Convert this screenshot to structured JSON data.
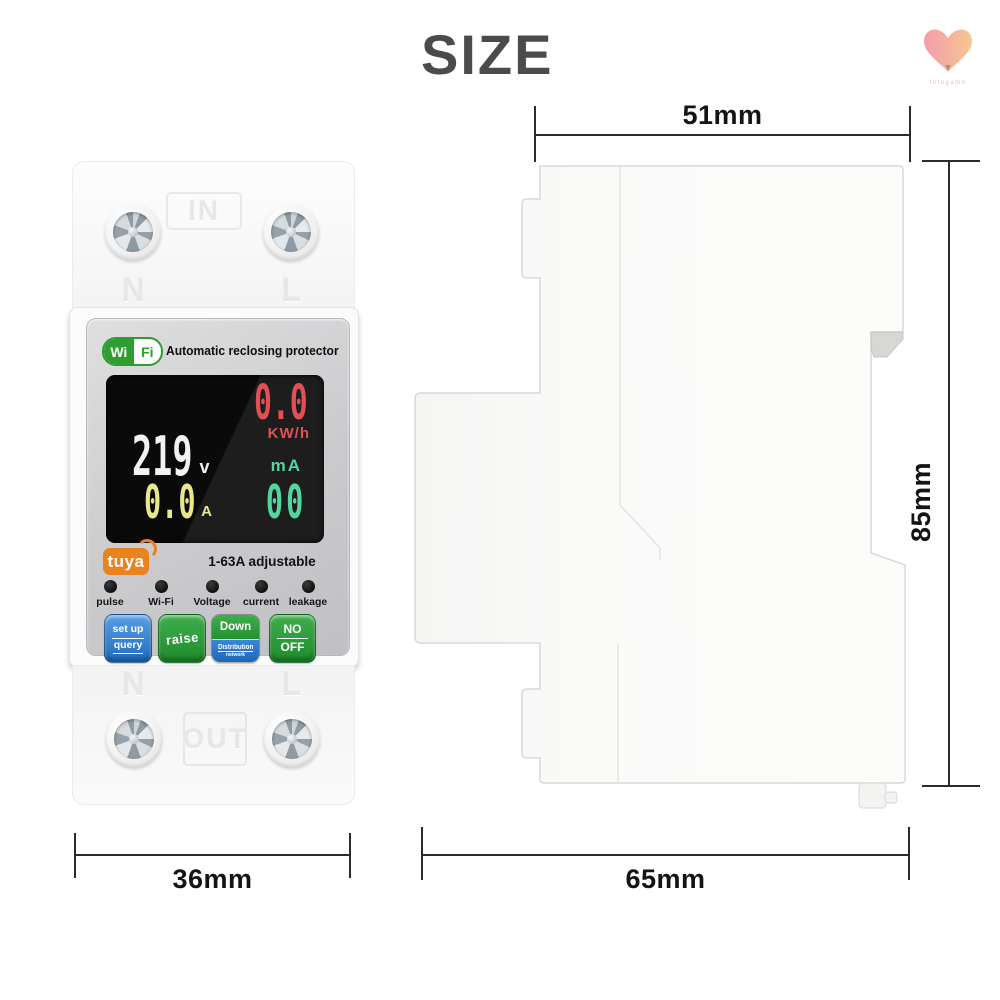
{
  "title": "SIZE",
  "watermark": {
    "brand": "fotogamo"
  },
  "front_view": {
    "terminal_top": {
      "label": "IN",
      "left": "N",
      "right": "L"
    },
    "header": {
      "wifi_left": "Wi",
      "wifi_right": "Fi",
      "product_name": "Automatic reclosing protector"
    },
    "display": {
      "energy_value": "0.0",
      "energy_unit": "KW/h",
      "voltage_value": "219",
      "voltage_unit": "v",
      "current_value": "0.0",
      "current_unit": "A",
      "leakage_unit": "mA",
      "leakage_value": "00"
    },
    "brand": "tuya",
    "rating": "1-63A adjustable",
    "indicators": [
      "pulse",
      "Wi-Fi",
      "Voltage",
      "current",
      "leakage"
    ],
    "buttons": {
      "setup": {
        "line1": "set up",
        "line2": "query"
      },
      "raise": {
        "label": "raise"
      },
      "down": {
        "label": "Down",
        "sub1": "Distribution",
        "sub2": "network"
      },
      "onoff": {
        "line1": "NO",
        "line2": "OFF"
      }
    },
    "terminal_bottom": {
      "label": "OUT",
      "left": "N",
      "right": "L"
    }
  },
  "dimensions": {
    "top_width": "51mm",
    "height": "85mm",
    "front_width": "36mm",
    "side_depth": "65mm"
  },
  "colors": {
    "title_gray": "#4b4b4b",
    "wifi_green": "#2e9e30",
    "tuya_orange": "#ea8220",
    "display_red": "#e05055",
    "display_white": "#f2f2f2",
    "display_yellow": "#e8e88a",
    "display_teal": "#52d6a0",
    "button_blue": "#1f6dc2",
    "button_green": "#1e8c2b"
  }
}
